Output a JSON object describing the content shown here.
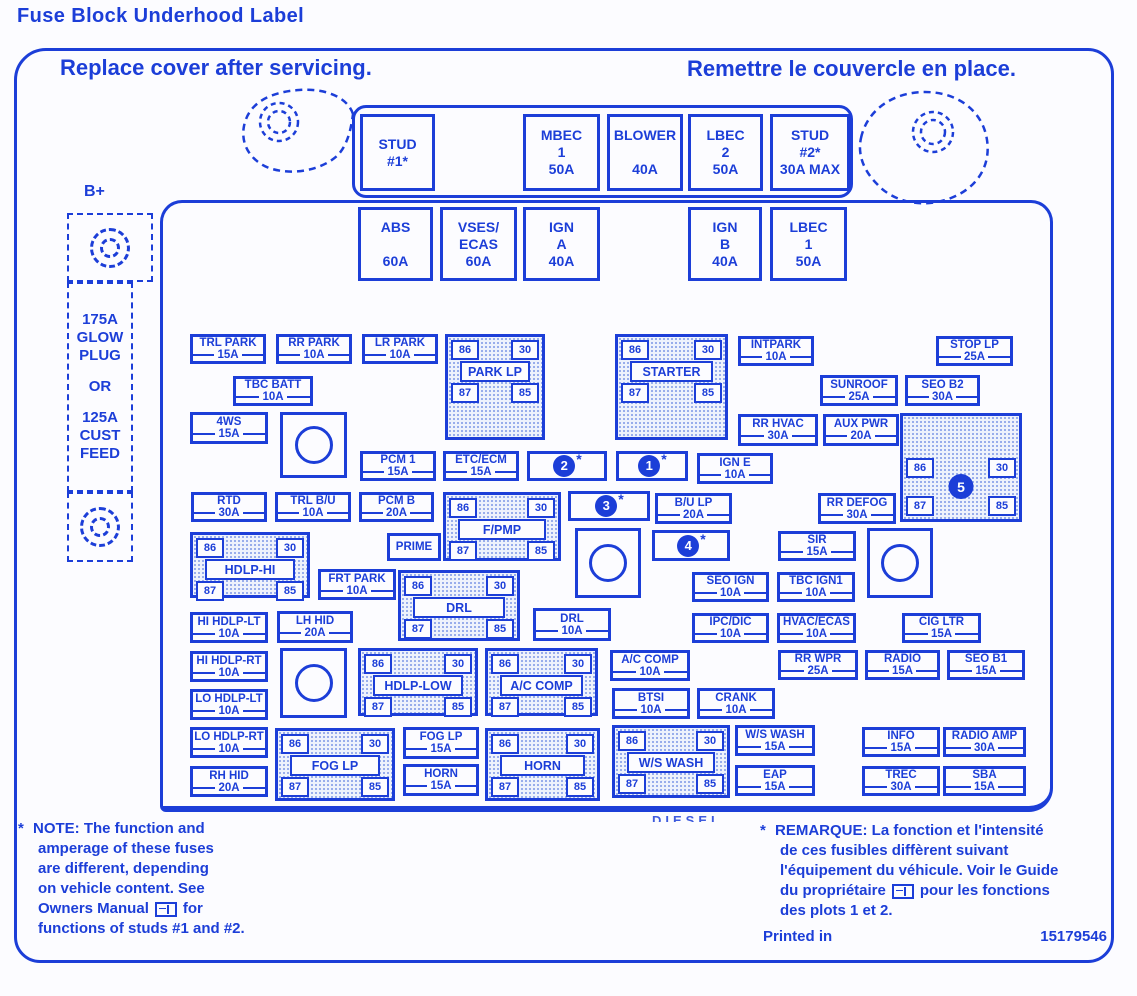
{
  "title": "Fuse Block  Underhood Label",
  "header": {
    "left": "Replace cover after servicing.",
    "right": "Remettre le couvercle en place."
  },
  "colors": {
    "ink": "#1c3ed8",
    "hatch_dot": "#8fa5e9",
    "paper": "#fcfcff"
  },
  "b_plus": {
    "label": "B+",
    "glow_lines": [
      "175A",
      "GLOW",
      "PLUG",
      "OR",
      "125A",
      "CUST",
      "FEED"
    ]
  },
  "top_row": {
    "boxes": [
      {
        "lines": [
          "STUD",
          "#1*"
        ],
        "x": 360,
        "y": 114,
        "w": 75,
        "h": 77
      },
      {
        "lines": [
          "MBEC",
          "1",
          "50A"
        ],
        "x": 523,
        "y": 114,
        "w": 77,
        "h": 77
      },
      {
        "lines": [
          "BLOWER",
          "",
          "40A"
        ],
        "x": 607,
        "y": 114,
        "w": 76,
        "h": 77
      },
      {
        "lines": [
          "LBEC",
          "2",
          "50A"
        ],
        "x": 688,
        "y": 114,
        "w": 75,
        "h": 77
      },
      {
        "lines": [
          "STUD",
          "#2*",
          "30A MAX"
        ],
        "x": 770,
        "y": 114,
        "w": 80,
        "h": 77
      }
    ]
  },
  "second_row": {
    "boxes": [
      {
        "lines": [
          "ABS",
          "",
          "60A"
        ],
        "x": 358,
        "y": 207,
        "w": 75,
        "h": 74
      },
      {
        "lines": [
          "VSES/",
          "ECAS",
          "60A"
        ],
        "x": 440,
        "y": 207,
        "w": 77,
        "h": 74
      },
      {
        "lines": [
          "IGN",
          "A",
          "40A"
        ],
        "x": 523,
        "y": 207,
        "w": 77,
        "h": 74
      },
      {
        "lines": [
          "IGN",
          "B",
          "40A"
        ],
        "x": 688,
        "y": 207,
        "w": 74,
        "h": 74
      },
      {
        "lines": [
          "LBEC",
          "1",
          "50A"
        ],
        "x": 770,
        "y": 207,
        "w": 77,
        "h": 74
      }
    ]
  },
  "fuses": [
    {
      "name": "TRL PARK",
      "amp": "15A",
      "x": 190,
      "y": 334,
      "w": 76,
      "h": 30
    },
    {
      "name": "RR PARK",
      "amp": "10A",
      "x": 276,
      "y": 334,
      "w": 76,
      "h": 30
    },
    {
      "name": "LR PARK",
      "amp": "10A",
      "x": 362,
      "y": 334,
      "w": 76,
      "h": 30
    },
    {
      "name": "INTPARK",
      "amp": "10A",
      "x": 738,
      "y": 336,
      "w": 76,
      "h": 30
    },
    {
      "name": "STOP LP",
      "amp": "25A",
      "x": 936,
      "y": 336,
      "w": 77,
      "h": 30
    },
    {
      "name": "TBC BATT",
      "amp": "10A",
      "x": 233,
      "y": 376,
      "w": 80,
      "h": 30
    },
    {
      "name": "SUNROOF",
      "amp": "25A",
      "x": 820,
      "y": 375,
      "w": 78,
      "h": 31
    },
    {
      "name": "SEO B2",
      "amp": "30A",
      "x": 905,
      "y": 375,
      "w": 75,
      "h": 31
    },
    {
      "name": "4WS",
      "amp": "15A",
      "x": 190,
      "y": 412,
      "w": 78,
      "h": 32
    },
    {
      "name": "RR HVAC",
      "amp": "30A",
      "x": 738,
      "y": 414,
      "w": 80,
      "h": 32
    },
    {
      "name": "AUX PWR",
      "amp": "20A",
      "x": 823,
      "y": 414,
      "w": 76,
      "h": 32
    },
    {
      "name": "PCM 1",
      "amp": "15A",
      "x": 360,
      "y": 451,
      "w": 76,
      "h": 30
    },
    {
      "name": "ETC/ECM",
      "amp": "15A",
      "x": 443,
      "y": 451,
      "w": 76,
      "h": 30
    },
    {
      "name": "IGN E",
      "amp": "10A",
      "x": 697,
      "y": 453,
      "w": 76,
      "h": 31
    },
    {
      "name": "RTD",
      "amp": "30A",
      "x": 191,
      "y": 492,
      "w": 76,
      "h": 30
    },
    {
      "name": "TRL B/U",
      "amp": "10A",
      "x": 275,
      "y": 492,
      "w": 76,
      "h": 30
    },
    {
      "name": "PCM B",
      "amp": "20A",
      "x": 359,
      "y": 492,
      "w": 75,
      "h": 30
    },
    {
      "name": "B/U LP",
      "amp": "20A",
      "x": 655,
      "y": 493,
      "w": 77,
      "h": 31
    },
    {
      "name": "RR DEFOG",
      "amp": "30A",
      "x": 818,
      "y": 493,
      "w": 78,
      "h": 31
    },
    {
      "name": "PRIME",
      "amp": "",
      "x": 387,
      "y": 533,
      "w": 54,
      "h": 28
    },
    {
      "name": "SIR",
      "amp": "15A",
      "x": 778,
      "y": 531,
      "w": 78,
      "h": 30
    },
    {
      "name": "FRT PARK",
      "amp": "10A",
      "x": 318,
      "y": 569,
      "w": 78,
      "h": 31
    },
    {
      "name": "SEO IGN",
      "amp": "10A",
      "x": 692,
      "y": 572,
      "w": 77,
      "h": 30
    },
    {
      "name": "TBC IGN1",
      "amp": "10A",
      "x": 777,
      "y": 572,
      "w": 78,
      "h": 30
    },
    {
      "name": "HI HDLP-LT",
      "amp": "10A",
      "x": 190,
      "y": 612,
      "w": 78,
      "h": 31
    },
    {
      "name": "LH HID",
      "amp": "20A",
      "x": 277,
      "y": 611,
      "w": 76,
      "h": 32
    },
    {
      "name": "DRL",
      "amp": "10A",
      "x": 533,
      "y": 608,
      "w": 78,
      "h": 33
    },
    {
      "name": "IPC/DIC",
      "amp": "10A",
      "x": 692,
      "y": 613,
      "w": 77,
      "h": 30
    },
    {
      "name": "HVAC/ECAS",
      "amp": "10A",
      "x": 777,
      "y": 613,
      "w": 79,
      "h": 30
    },
    {
      "name": "CIG LTR",
      "amp": "15A",
      "x": 902,
      "y": 613,
      "w": 79,
      "h": 30
    },
    {
      "name": "HI HDLP-RT",
      "amp": "10A",
      "x": 190,
      "y": 651,
      "w": 78,
      "h": 31
    },
    {
      "name": "A/C COMP",
      "amp": "10A",
      "x": 610,
      "y": 650,
      "w": 80,
      "h": 31
    },
    {
      "name": "RR WPR",
      "amp": "25A",
      "x": 778,
      "y": 650,
      "w": 80,
      "h": 30
    },
    {
      "name": "RADIO",
      "amp": "15A",
      "x": 865,
      "y": 650,
      "w": 75,
      "h": 30
    },
    {
      "name": "SEO B1",
      "amp": "15A",
      "x": 947,
      "y": 650,
      "w": 78,
      "h": 30
    },
    {
      "name": "LO HDLP-LT",
      "amp": "10A",
      "x": 190,
      "y": 689,
      "w": 78,
      "h": 31
    },
    {
      "name": "BTSI",
      "amp": "10A",
      "x": 612,
      "y": 688,
      "w": 78,
      "h": 31
    },
    {
      "name": "CRANK",
      "amp": "10A",
      "x": 697,
      "y": 688,
      "w": 78,
      "h": 31
    },
    {
      "name": "LO HDLP-RT",
      "amp": "10A",
      "x": 190,
      "y": 727,
      "w": 78,
      "h": 31
    },
    {
      "name": "FOG LP",
      "amp": "15A",
      "x": 403,
      "y": 727,
      "w": 76,
      "h": 32
    },
    {
      "name": "W/S WASH",
      "amp": "15A",
      "x": 735,
      "y": 725,
      "w": 80,
      "h": 31
    },
    {
      "name": "INFO",
      "amp": "15A",
      "x": 862,
      "y": 727,
      "w": 78,
      "h": 30
    },
    {
      "name": "RADIO AMP",
      "amp": "30A",
      "x": 943,
      "y": 727,
      "w": 83,
      "h": 30
    },
    {
      "name": "RH HID",
      "amp": "20A",
      "x": 190,
      "y": 766,
      "w": 78,
      "h": 31
    },
    {
      "name": "HORN",
      "amp": "15A",
      "x": 403,
      "y": 764,
      "w": 76,
      "h": 32
    },
    {
      "name": "EAP",
      "amp": "15A",
      "x": 735,
      "y": 765,
      "w": 80,
      "h": 31
    },
    {
      "name": "TREC",
      "amp": "30A",
      "x": 862,
      "y": 766,
      "w": 78,
      "h": 30
    },
    {
      "name": "SBA",
      "amp": "15A",
      "x": 943,
      "y": 766,
      "w": 83,
      "h": 30
    }
  ],
  "numbered_fuses": [
    {
      "num": "2",
      "star": "*",
      "x": 527,
      "y": 451,
      "w": 80,
      "h": 30
    },
    {
      "num": "1",
      "star": "*",
      "x": 616,
      "y": 451,
      "w": 72,
      "h": 30
    },
    {
      "num": "3",
      "star": "*",
      "x": 568,
      "y": 491,
      "w": 82,
      "h": 30
    },
    {
      "num": "4",
      "star": "*",
      "x": 652,
      "y": 530,
      "w": 78,
      "h": 31
    }
  ],
  "relays": [
    {
      "name": "PARK LP",
      "variant": "std",
      "t": [
        "86",
        "30",
        "87",
        "85"
      ],
      "x": 445,
      "y": 334,
      "w": 100,
      "h": 106
    },
    {
      "name": "STARTER",
      "variant": "std",
      "t": [
        "86",
        "30",
        "87",
        "85"
      ],
      "x": 615,
      "y": 334,
      "w": 113,
      "h": 106
    },
    {
      "name": "5",
      "num": "5",
      "variant": "num",
      "t": [
        "86",
        "30",
        "87",
        "85"
      ],
      "x": 900,
      "y": 413,
      "w": 122,
      "h": 109
    },
    {
      "name": "F/PMP",
      "variant": "std",
      "t": [
        "86",
        "30",
        "87",
        "85"
      ],
      "x": 443,
      "y": 492,
      "w": 118,
      "h": 69
    },
    {
      "name": "HDLP-HI",
      "variant": "std",
      "t": [
        "86",
        "30",
        "87",
        "85"
      ],
      "x": 190,
      "y": 532,
      "w": 120,
      "h": 66
    },
    {
      "name": "DRL",
      "variant": "std",
      "t": [
        "86",
        "30",
        "87",
        "85"
      ],
      "x": 398,
      "y": 570,
      "w": 122,
      "h": 71
    },
    {
      "name": "HDLP-LOW",
      "variant": "std",
      "t": [
        "86",
        "30",
        "87",
        "85"
      ],
      "x": 358,
      "y": 648,
      "w": 120,
      "h": 68
    },
    {
      "name": "A/C COMP",
      "variant": "std",
      "t": [
        "86",
        "30",
        "87",
        "85"
      ],
      "x": 485,
      "y": 648,
      "w": 113,
      "h": 68
    },
    {
      "name": "FOG LP",
      "variant": "std",
      "t": [
        "86",
        "30",
        "87",
        "85"
      ],
      "x": 275,
      "y": 728,
      "w": 120,
      "h": 73
    },
    {
      "name": "HORN",
      "variant": "std",
      "t": [
        "86",
        "30",
        "87",
        "85"
      ],
      "x": 485,
      "y": 728,
      "w": 115,
      "h": 73
    },
    {
      "name": "W/S WASH",
      "variant": "std",
      "t": [
        "86",
        "30",
        "87",
        "85"
      ],
      "x": 612,
      "y": 725,
      "w": 118,
      "h": 73
    }
  ],
  "sockets": [
    {
      "x": 280,
      "y": 412,
      "w": 67,
      "h": 66
    },
    {
      "x": 575,
      "y": 528,
      "w": 66,
      "h": 70
    },
    {
      "x": 867,
      "y": 528,
      "w": 66,
      "h": 70
    },
    {
      "x": 280,
      "y": 648,
      "w": 67,
      "h": 70
    }
  ],
  "note_en": {
    "star": "*",
    "lines": [
      "NOTE:  The function and",
      "amperage of these fuses",
      "are different, depending",
      "on vehicle content.  See"
    ],
    "icon_line": {
      "pre": "Owners Manual",
      "post": "for"
    },
    "last": "functions of studs #1 and #2."
  },
  "note_fr": {
    "star": "*",
    "lines": [
      "REMARQUE:  La fonction et l'intensité",
      "de ces fusibles diffèrent suivant",
      "l'équipement du véhicule. Voir le Guide"
    ],
    "icon_line": {
      "pre": "du propriétaire",
      "post": "pour les fonctions"
    },
    "last": "des plots 1 et 2."
  },
  "footer": {
    "printed": "Printed in",
    "part_number": "15179546",
    "partial_label": "DIESEL"
  }
}
